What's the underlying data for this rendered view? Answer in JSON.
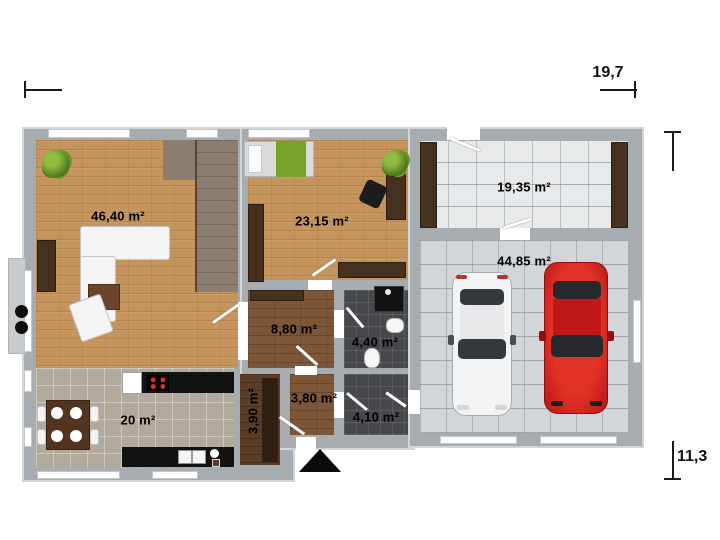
{
  "plan_title": "single-storey house floor plan with garage",
  "dimensions": {
    "width_label": "19,7",
    "depth_label": "11,3"
  },
  "rooms": [
    {
      "name": "living-room",
      "area": "46,40 m²",
      "floor": "light wood"
    },
    {
      "name": "kitchen",
      "area": "20 m²",
      "floor": "beige tile"
    },
    {
      "name": "bedroom",
      "area": "23,15 m²",
      "floor": "light wood"
    },
    {
      "name": "hallway",
      "area": "8,80 m²",
      "floor": "brown wood"
    },
    {
      "name": "bathroom",
      "area": "4,40 m²",
      "floor": "dark tile"
    },
    {
      "name": "closet",
      "area": "3,90 m²",
      "floor": "dark wood"
    },
    {
      "name": "entry-hall",
      "area": "3,80 m²",
      "floor": "brown wood"
    },
    {
      "name": "wc",
      "area": "4,10 m²",
      "floor": "dark tile"
    },
    {
      "name": "storage-room",
      "area": "19,35 m²",
      "floor": "white tile"
    },
    {
      "name": "garage",
      "area": "44,85 m²",
      "floor": "gray tile"
    }
  ],
  "colors": {
    "wall": "#a7acb0",
    "wood_light": "#c6955e",
    "wood_mid": "#7d5738",
    "wood_dark": "#5d3d26",
    "tile_dark": "#46484c",
    "tile_beige": "#b0a99c",
    "tile_white": "#e7e9ea",
    "tile_gray": "#d3d6d8",
    "car_red": "#c81e1e",
    "car_white": "#f2f3f4",
    "blanket_green": "#76a42a"
  }
}
